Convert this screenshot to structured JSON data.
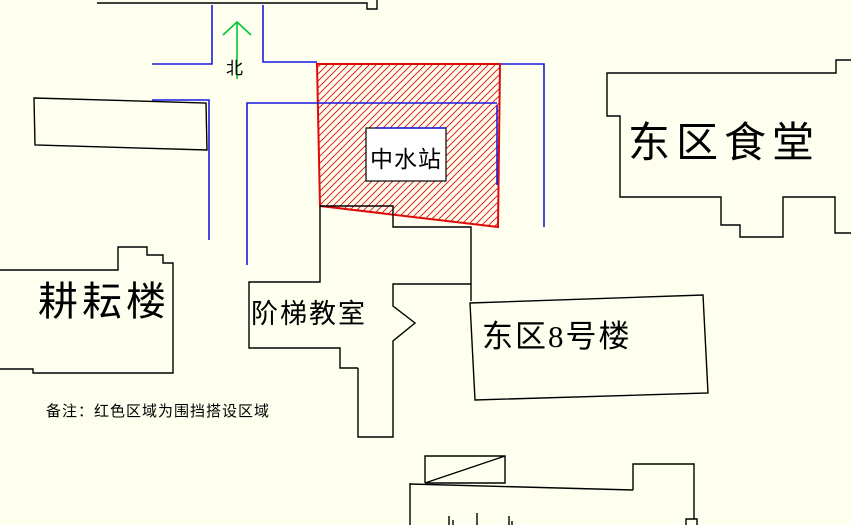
{
  "colors": {
    "background": "#FFFFEF",
    "building_outline": "#000000",
    "road": "#1A1ADF",
    "enclosure": "#DD0A0A",
    "north_arrow": "#00C832",
    "text": "#000000"
  },
  "compass": {
    "label": "北"
  },
  "labels": {
    "reclaimed_water_station": "中水站",
    "east_canteen": "东区食堂",
    "gengyun_building": "耕耘楼",
    "lecture_hall": "阶梯教室",
    "east_building_8": "东区8号楼"
  },
  "note": {
    "text": "备注：红色区域为围挡搭设区域"
  }
}
